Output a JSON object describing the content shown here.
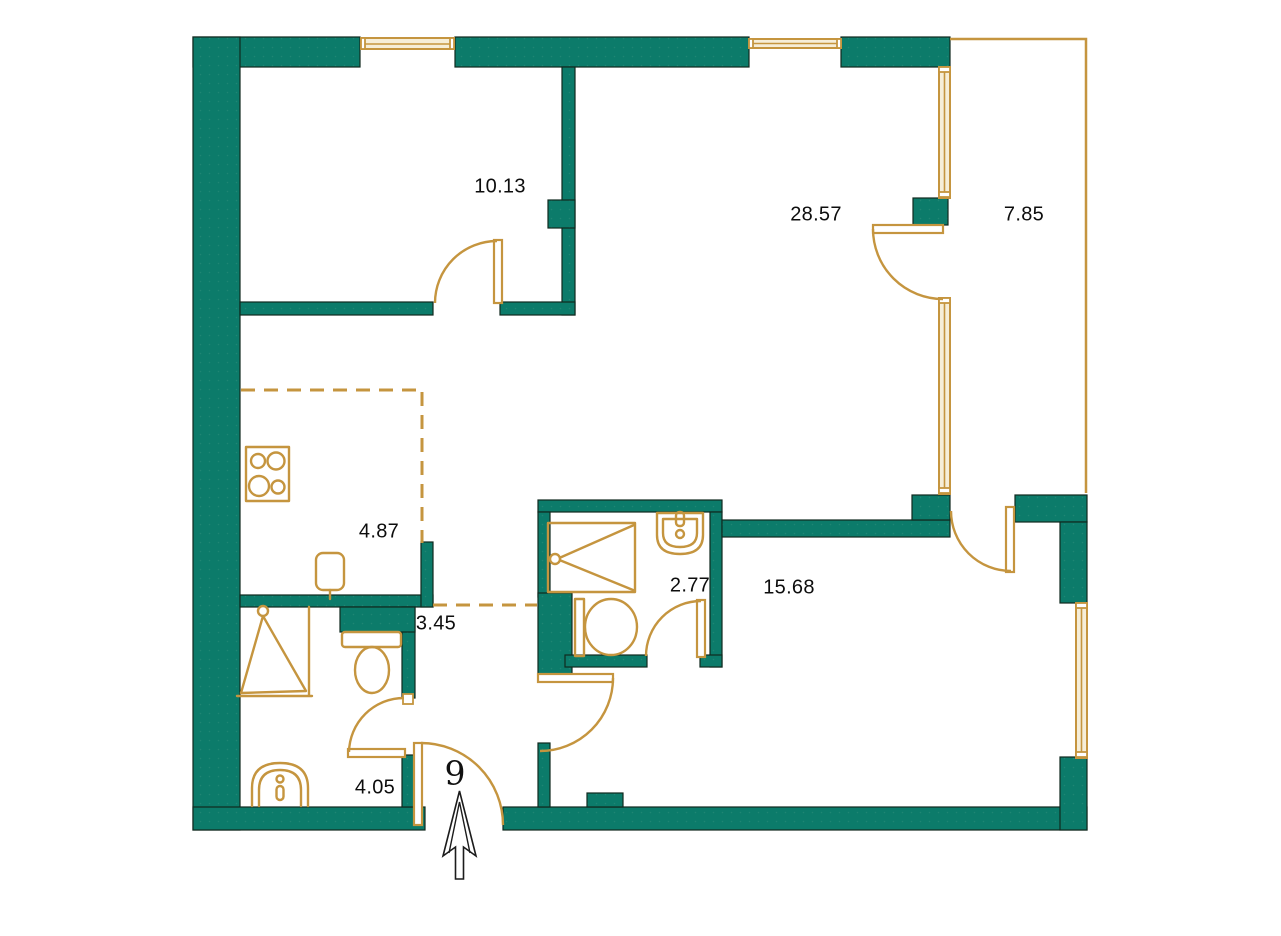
{
  "plan": {
    "type": "apartment-floor-plan",
    "unit_number": "9"
  },
  "colors": {
    "wall": "#0c7b6a",
    "wall_dot": "#1f8673",
    "wall_stroke": "#10291f",
    "gold": "#c5953f",
    "window_fill": "#f6eed8",
    "text": "#0d0d0d",
    "background": "#ffffff"
  },
  "rooms": [
    {
      "id": "bedroom",
      "area_m2": "10.13"
    },
    {
      "id": "living-room",
      "area_m2": "28.57"
    },
    {
      "id": "balcony",
      "area_m2": "7.85"
    },
    {
      "id": "kitchen",
      "area_m2": "4.87"
    },
    {
      "id": "corridor",
      "area_m2": "3.45"
    },
    {
      "id": "bathroom",
      "area_m2": "2.77"
    },
    {
      "id": "hall",
      "area_m2": "15.68"
    },
    {
      "id": "shower-room",
      "area_m2": "4.05"
    }
  ],
  "entrance": {
    "unit_number": "9",
    "direction_icon": "entrance-arrow-up"
  },
  "fixtures": {
    "kitchen": [
      "stove-icon",
      "kitchen-sink-icon"
    ],
    "bathroom": [
      "shower-icon",
      "toilet-icon",
      "washbasin-icon"
    ],
    "shower_room": [
      "shower-icon",
      "toilet-icon",
      "washbasin-icon"
    ]
  }
}
